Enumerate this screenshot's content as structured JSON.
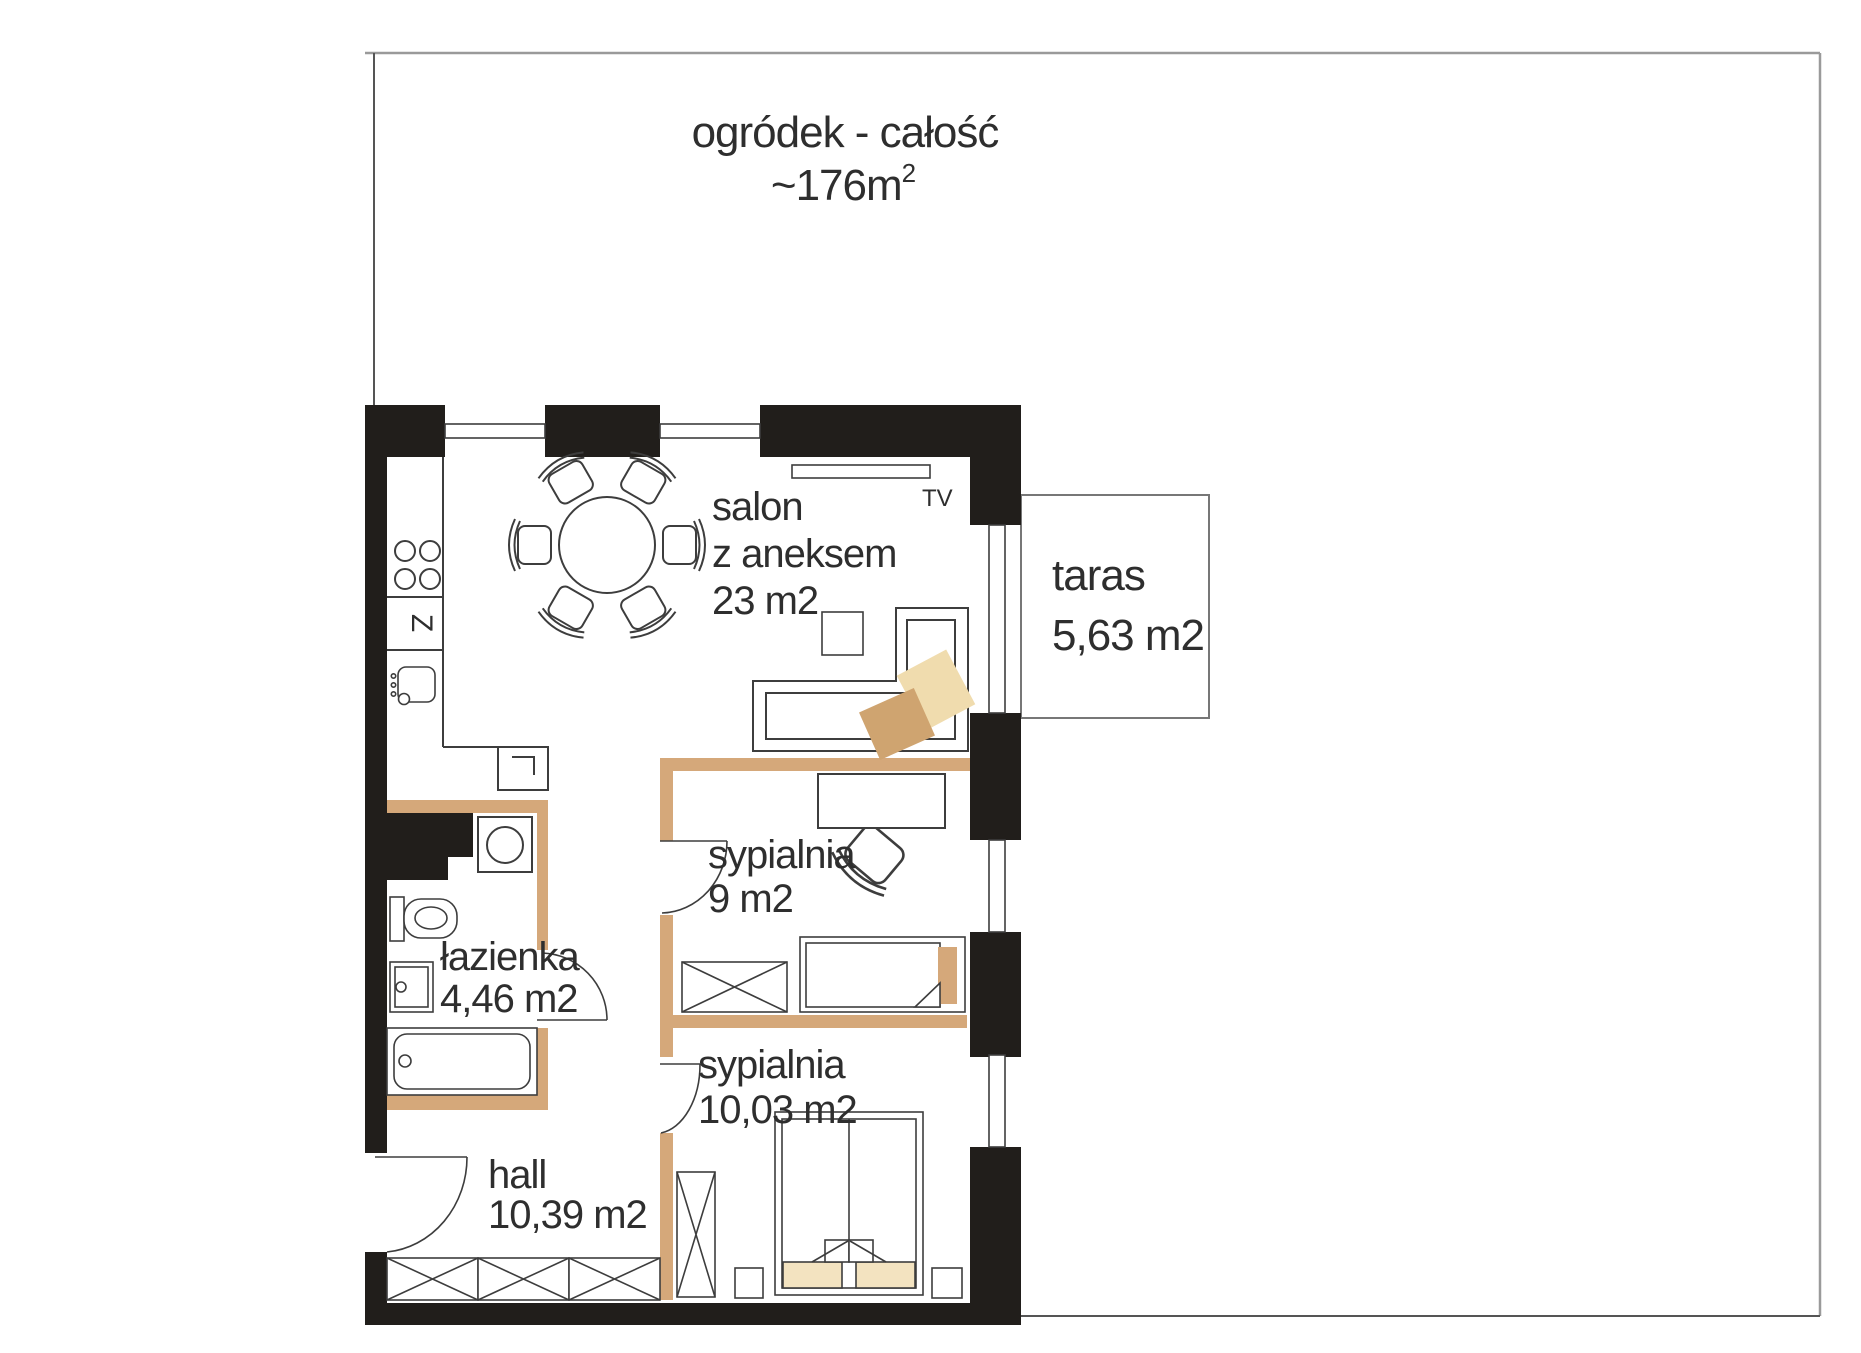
{
  "garden": {
    "title": "ogródek - całość",
    "area_main": "~176m",
    "area_sup": "2"
  },
  "rooms": {
    "salon": {
      "line1": "salon",
      "line2": "z aneksem",
      "area": "23 m2"
    },
    "taras": {
      "name": "taras",
      "area": "5,63 m2"
    },
    "sypialnia9": {
      "name": "sypialnia",
      "area": "9 m2"
    },
    "lazienka": {
      "name": "łazienka",
      "area": "4,46 m2"
    },
    "sypialnia10": {
      "name": "sypialnia",
      "area": "10,03 m2"
    },
    "hall": {
      "name": "hall",
      "area": "10,39 m2"
    }
  },
  "labels": {
    "tv": "TV",
    "dishwasher": "Z"
  },
  "colors": {
    "wall": "#211e1b",
    "partition": "#d5a87a",
    "cushion_tan": "#cfa470",
    "cushion_cream": "#f0dcae",
    "bedding": "#f3e3c0",
    "outline": "#3d3d3d",
    "garden_line": "#9a9a9a",
    "text": "#2e2e2e"
  }
}
